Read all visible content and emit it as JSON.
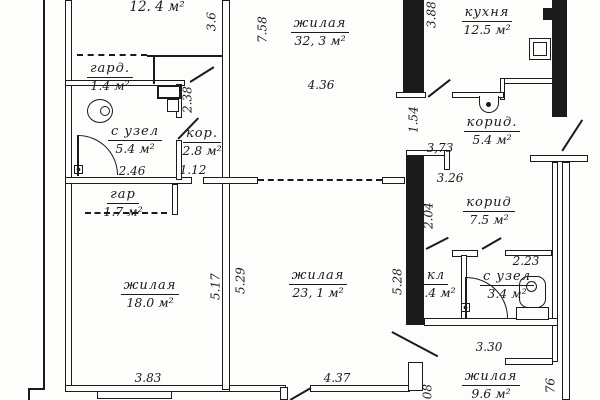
{
  "rooms": {
    "top_left": {
      "area": "12. 4 м²"
    },
    "gard": {
      "name": "гард.",
      "area": "1.4 м²"
    },
    "suzel1": {
      "name": "с узел",
      "area": "5.4 м²"
    },
    "kor": {
      "name": "кор.",
      "area": "2.8 м²"
    },
    "gar": {
      "name": "гар",
      "area": "1.7 м²"
    },
    "zh18": {
      "name": "жилая",
      "area": "18.0 м²"
    },
    "zh32": {
      "name": "жилая",
      "area": "32, 3 м²"
    },
    "zh23": {
      "name": "жилая",
      "area": "23, 1 м²"
    },
    "kitchen": {
      "name": "кухня",
      "area": "12.5 м²"
    },
    "korid54": {
      "name": "корид.",
      "area": "5.4 м²"
    },
    "korid75": {
      "name": "корид",
      "area": "7.5 м²"
    },
    "kl": {
      "name": "кл",
      "area": "1.4 м²"
    },
    "suzel2": {
      "name": "с узел",
      "area": "3.4 м²"
    },
    "zh96": {
      "name": "жилая",
      "area": "9.6 м²"
    }
  },
  "dims": {
    "v36": "3.6",
    "v758": "7.58",
    "v436": "4.36",
    "v388": "3.88",
    "v154": "1.54",
    "v238": "2.38",
    "v246": "2.46",
    "v112": "1.12",
    "v373": "3,73",
    "v326": "3.26",
    "v204": "2.04",
    "v223": "2.23",
    "v517": "5.17",
    "v529": "5.29",
    "v528": "5.28",
    "v383": "3.83",
    "v437": "4.37",
    "v330": "3.30",
    "v08": "08",
    "v76": "76"
  },
  "colors": {
    "ink": "#1b1b1b",
    "paper": "#fdfdfb"
  }
}
